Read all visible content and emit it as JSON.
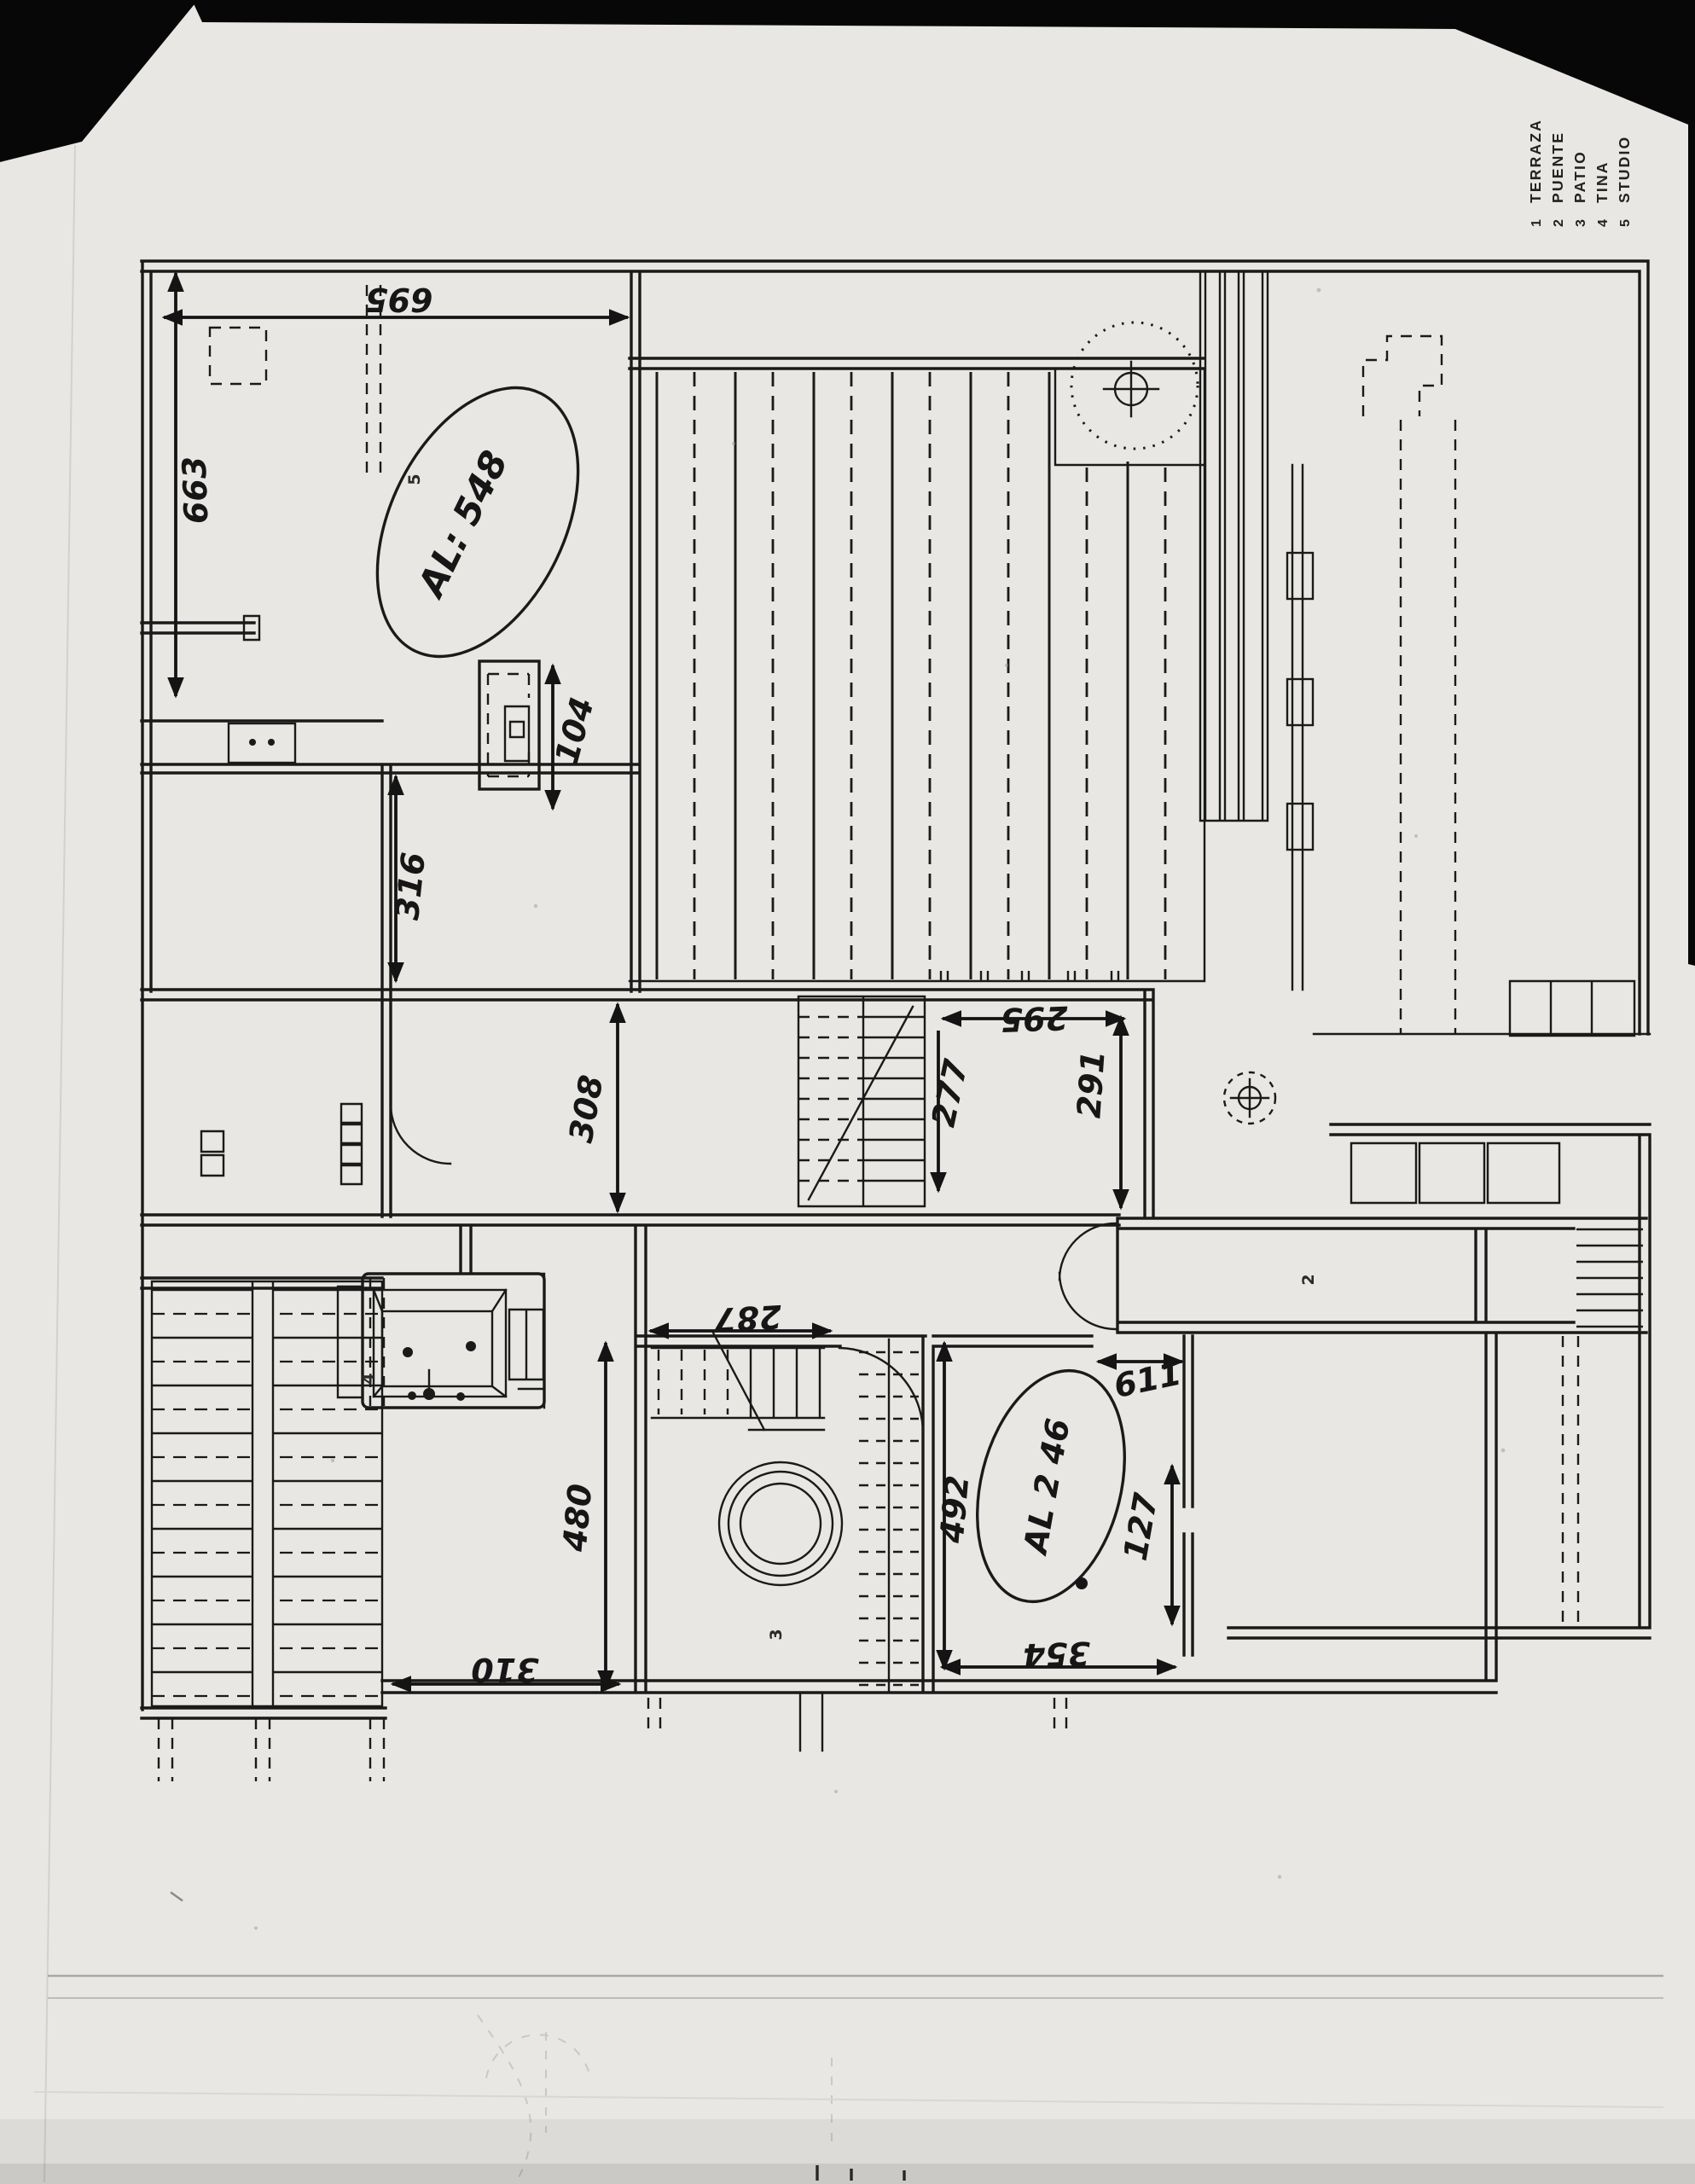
{
  "document_type": "scanned floor plan sketch",
  "colors": {
    "paper": "#e8e7e3",
    "ink": "#1a1a1a",
    "scan_background": "#060606",
    "ghost_lines": "#c9c8c4"
  },
  "legend": {
    "items": [
      {
        "num": "1",
        "label": "TERRAZA"
      },
      {
        "num": "2",
        "label": "PUENTE"
      },
      {
        "num": "3",
        "label": "PATIO"
      },
      {
        "num": "4",
        "label": "TINA"
      },
      {
        "num": "5",
        "label": "STUDIO"
      }
    ]
  },
  "dims": {
    "d695": "695",
    "d663": "663",
    "d104": "104",
    "d316": "316",
    "d308": "308",
    "d295": "295",
    "d277": "277",
    "d291": "291",
    "d287": "287",
    "d480": "480",
    "d310": "310",
    "d492": "492",
    "d611": "611",
    "d127": "127",
    "d354": "354"
  },
  "annotations": {
    "al548": "AL: 548",
    "al246": "AL 2 46"
  },
  "rooms": {
    "puente": "2",
    "patio": "3",
    "tina": "4",
    "studio": "5"
  }
}
